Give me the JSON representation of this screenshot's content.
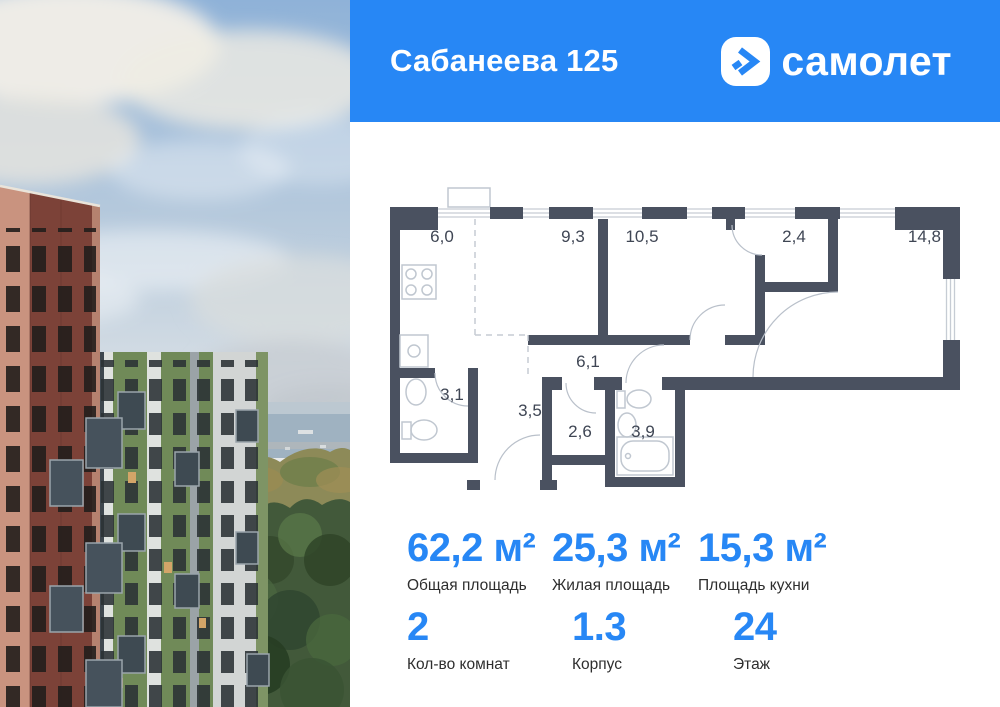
{
  "colors": {
    "brand_blue": "#2787F5",
    "plan_wall": "#4A5160",
    "plan_line": "#C6CCD4"
  },
  "header": {
    "title": "Сабанеева 125",
    "brand": "самолет"
  },
  "floorplan": {
    "rooms": [
      {
        "area": "6,0"
      },
      {
        "area": "9,3"
      },
      {
        "area": "10,5"
      },
      {
        "area": "2,4"
      },
      {
        "area": "14,8"
      },
      {
        "area": "3,1"
      },
      {
        "area": "3,5"
      },
      {
        "area": "6,1"
      },
      {
        "area": "2,6"
      },
      {
        "area": "3,9"
      }
    ]
  },
  "stats": {
    "primary": [
      {
        "value": "62,2 м²",
        "label": "Общая площадь"
      },
      {
        "value": "25,3 м²",
        "label": "Жилая площадь"
      },
      {
        "value": "15,3 м²",
        "label": "Площадь кухни"
      }
    ],
    "secondary": [
      {
        "value": "2",
        "label": "Кол-во комнат"
      },
      {
        "value": "1.3",
        "label": "Корпус"
      },
      {
        "value": "24",
        "label": "Этаж"
      }
    ]
  }
}
